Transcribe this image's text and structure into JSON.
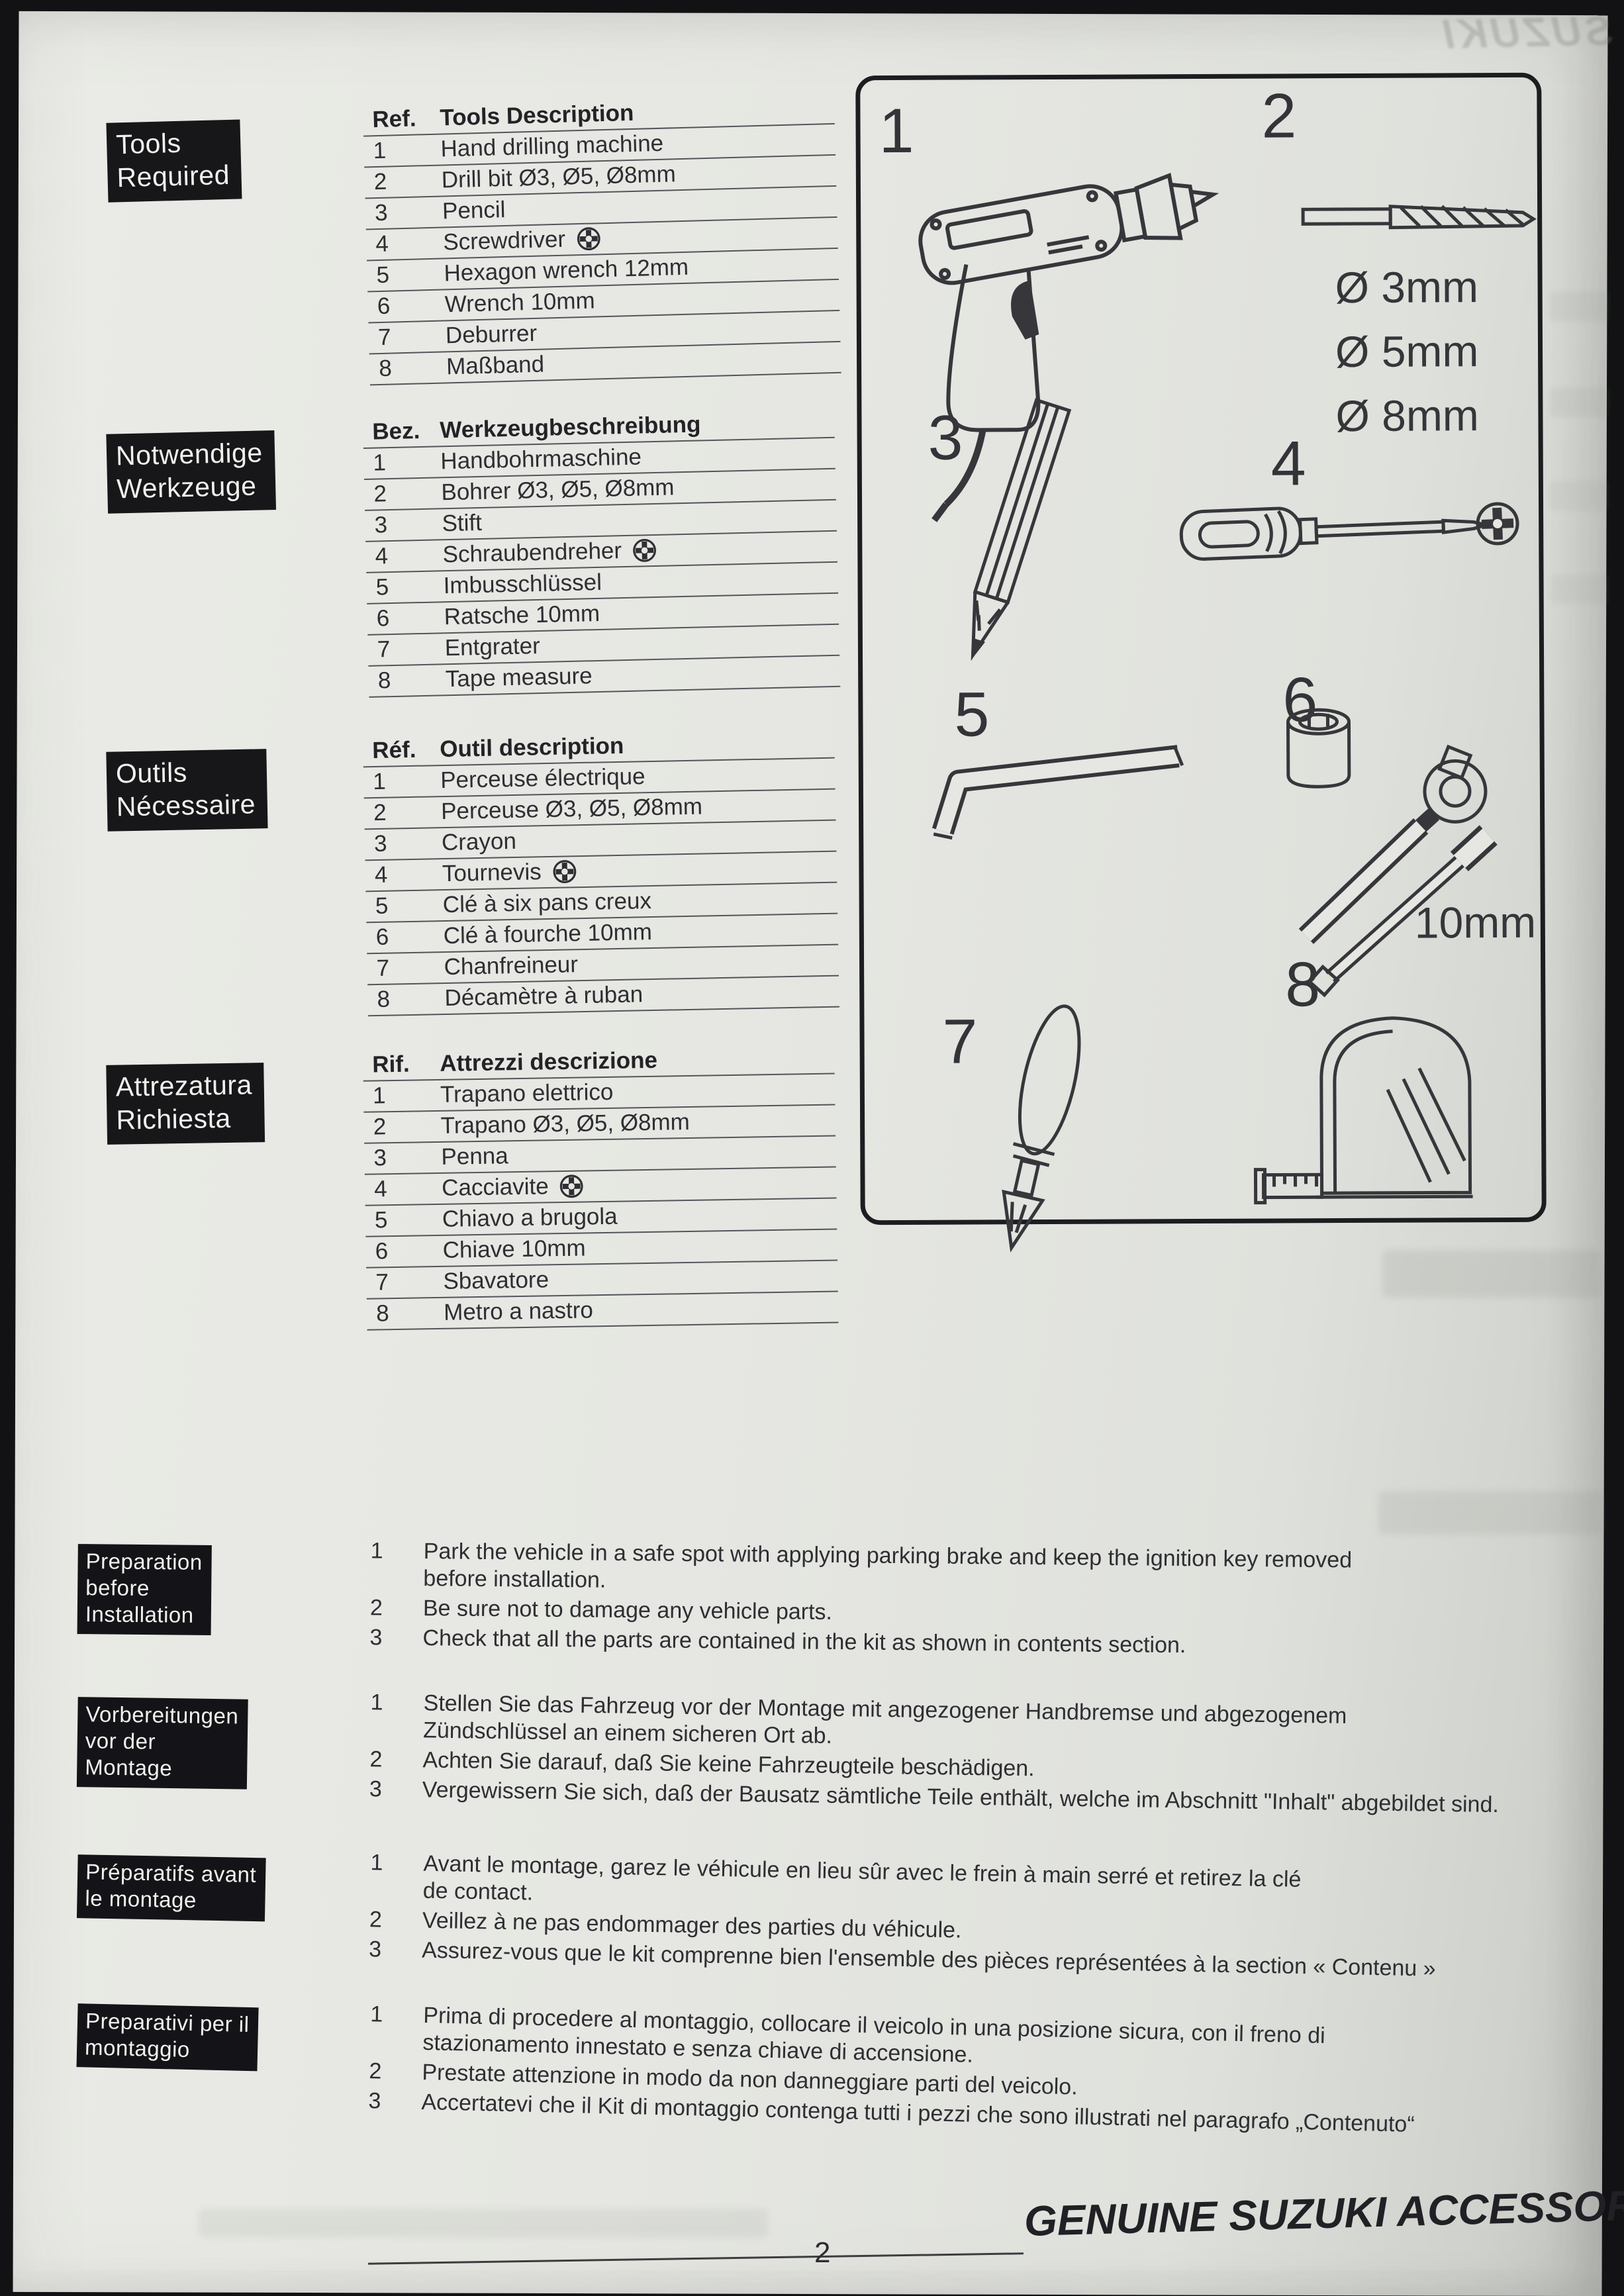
{
  "bleedthrough": {
    "text": "SUZUKI"
  },
  "sections": [
    {
      "label_lines": [
        "Tools",
        "Required"
      ],
      "ref_header": "Ref.",
      "desc_header": "Tools Description",
      "rows": [
        {
          "ref": "1",
          "desc": "Hand drilling machine"
        },
        {
          "ref": "2",
          "desc": "Drill bit Ø3, Ø5, Ø8mm"
        },
        {
          "ref": "3",
          "desc": "Pencil"
        },
        {
          "ref": "4",
          "desc": "Screwdriver",
          "phillips": true
        },
        {
          "ref": "5",
          "desc": "Hexagon wrench 12mm"
        },
        {
          "ref": "6",
          "desc": "Wrench 10mm"
        },
        {
          "ref": "7",
          "desc": "Deburrer"
        },
        {
          "ref": "8",
          "desc": "Maßband"
        }
      ]
    },
    {
      "label_lines": [
        "Notwendige",
        "Werkzeuge"
      ],
      "ref_header": "Bez.",
      "desc_header": "Werkzeugbeschreibung",
      "rows": [
        {
          "ref": "1",
          "desc": "Handbohrmaschine"
        },
        {
          "ref": "2",
          "desc": "Bohrer Ø3, Ø5, Ø8mm"
        },
        {
          "ref": "3",
          "desc": "Stift"
        },
        {
          "ref": "4",
          "desc": "Schraubendreher",
          "phillips": true
        },
        {
          "ref": "5",
          "desc": "Imbusschlüssel"
        },
        {
          "ref": "6",
          "desc": "Ratsche 10mm"
        },
        {
          "ref": "7",
          "desc": "Entgrater"
        },
        {
          "ref": "8",
          "desc": "Tape measure"
        }
      ]
    },
    {
      "label_lines": [
        "Outils",
        "Nécessaire"
      ],
      "ref_header": "Réf.",
      "desc_header": "Outil description",
      "rows": [
        {
          "ref": "1",
          "desc": "Perceuse électrique"
        },
        {
          "ref": "2",
          "desc": "Perceuse Ø3, Ø5, Ø8mm"
        },
        {
          "ref": "3",
          "desc": "Crayon"
        },
        {
          "ref": "4",
          "desc": "Tournevis",
          "phillips": true
        },
        {
          "ref": "5",
          "desc": "Clé à six pans creux"
        },
        {
          "ref": "6",
          "desc": "Clé à fourche 10mm"
        },
        {
          "ref": "7",
          "desc": "Chanfreineur"
        },
        {
          "ref": "8",
          "desc": "Décamètre à ruban"
        }
      ]
    },
    {
      "label_lines": [
        "Attrezatura",
        "Richiesta"
      ],
      "ref_header": "Rif.",
      "desc_header": "Attrezzi descrizione",
      "rows": [
        {
          "ref": "1",
          "desc": "Trapano elettrico"
        },
        {
          "ref": "2",
          "desc": "Trapano Ø3, Ø5, Ø8mm"
        },
        {
          "ref": "3",
          "desc": "Penna"
        },
        {
          "ref": "4",
          "desc": "Cacciavite",
          "phillips": true
        },
        {
          "ref": "5",
          "desc": "Chiavo a brugola"
        },
        {
          "ref": "6",
          "desc": "Chiave 10mm"
        },
        {
          "ref": "7",
          "desc": "Sbavatore"
        },
        {
          "ref": "8",
          "desc": "Metro a nastro"
        }
      ]
    }
  ],
  "illustration": {
    "numbers": [
      "1",
      "2",
      "3",
      "4",
      "5",
      "6",
      "7",
      "8"
    ],
    "drill_sizes": [
      "Ø 3mm",
      "Ø 5mm",
      "Ø 8mm"
    ],
    "socket_size": "10mm"
  },
  "preparation": [
    {
      "label_lines": [
        "Preparation",
        "before",
        "Installation"
      ],
      "items": [
        {
          "num": "1",
          "text": "Park the vehicle in a safe spot with applying parking brake and keep the ignition key removed\nbefore installation."
        },
        {
          "num": "2",
          "text": "Be sure not to damage any vehicle parts."
        },
        {
          "num": "3",
          "text": "Check that all the parts are contained in the kit as shown in contents section."
        }
      ]
    },
    {
      "label_lines": [
        "Vorbereitungen",
        "vor der",
        "Montage"
      ],
      "items": [
        {
          "num": "1",
          "text": "Stellen Sie das Fahrzeug vor der Montage mit angezogener Handbremse und abgezogenem\nZündschlüssel an einem sicheren Ort ab."
        },
        {
          "num": "2",
          "text": "Achten Sie darauf, daß Sie keine Fahrzeugteile beschädigen."
        },
        {
          "num": "3",
          "text": "Vergewissern Sie sich, daß der Bausatz sämtliche Teile enthält, welche im Abschnitt \"Inhalt\" abgebildet sind."
        }
      ]
    },
    {
      "label_lines": [
        "Préparatifs avant",
        "le montage"
      ],
      "items": [
        {
          "num": "1",
          "text": "Avant le montage, garez le véhicule en lieu sûr avec le frein à main serré et retirez la clé\nde contact."
        },
        {
          "num": "2",
          "text": "Veillez à ne pas endommager des parties du véhicule."
        },
        {
          "num": "3",
          "text": "Assurez-vous que le kit comprenne bien l'ensemble des pièces représentées à la section « Contenu »"
        }
      ]
    },
    {
      "label_lines": [
        "Preparativi per il",
        "montaggio"
      ],
      "items": [
        {
          "num": "1",
          "text": "Prima di procedere al montaggio, collocare il veicolo in una posizione sicura, con il freno di\nstazionamento innestato e senza chiave di accensione."
        },
        {
          "num": "2",
          "text": "Prestate attenzione in modo da non danneggiare parti del veicolo."
        },
        {
          "num": "3",
          "text": "Accertatevi che il Kit di montaggio contenga tutti i pezzi che sono illustrati nel paragrafo „Contenuto“"
        }
      ]
    }
  ],
  "footer": {
    "brand": "GENUINE SUZUKI ACCESSORIES",
    "page_number": "2"
  }
}
